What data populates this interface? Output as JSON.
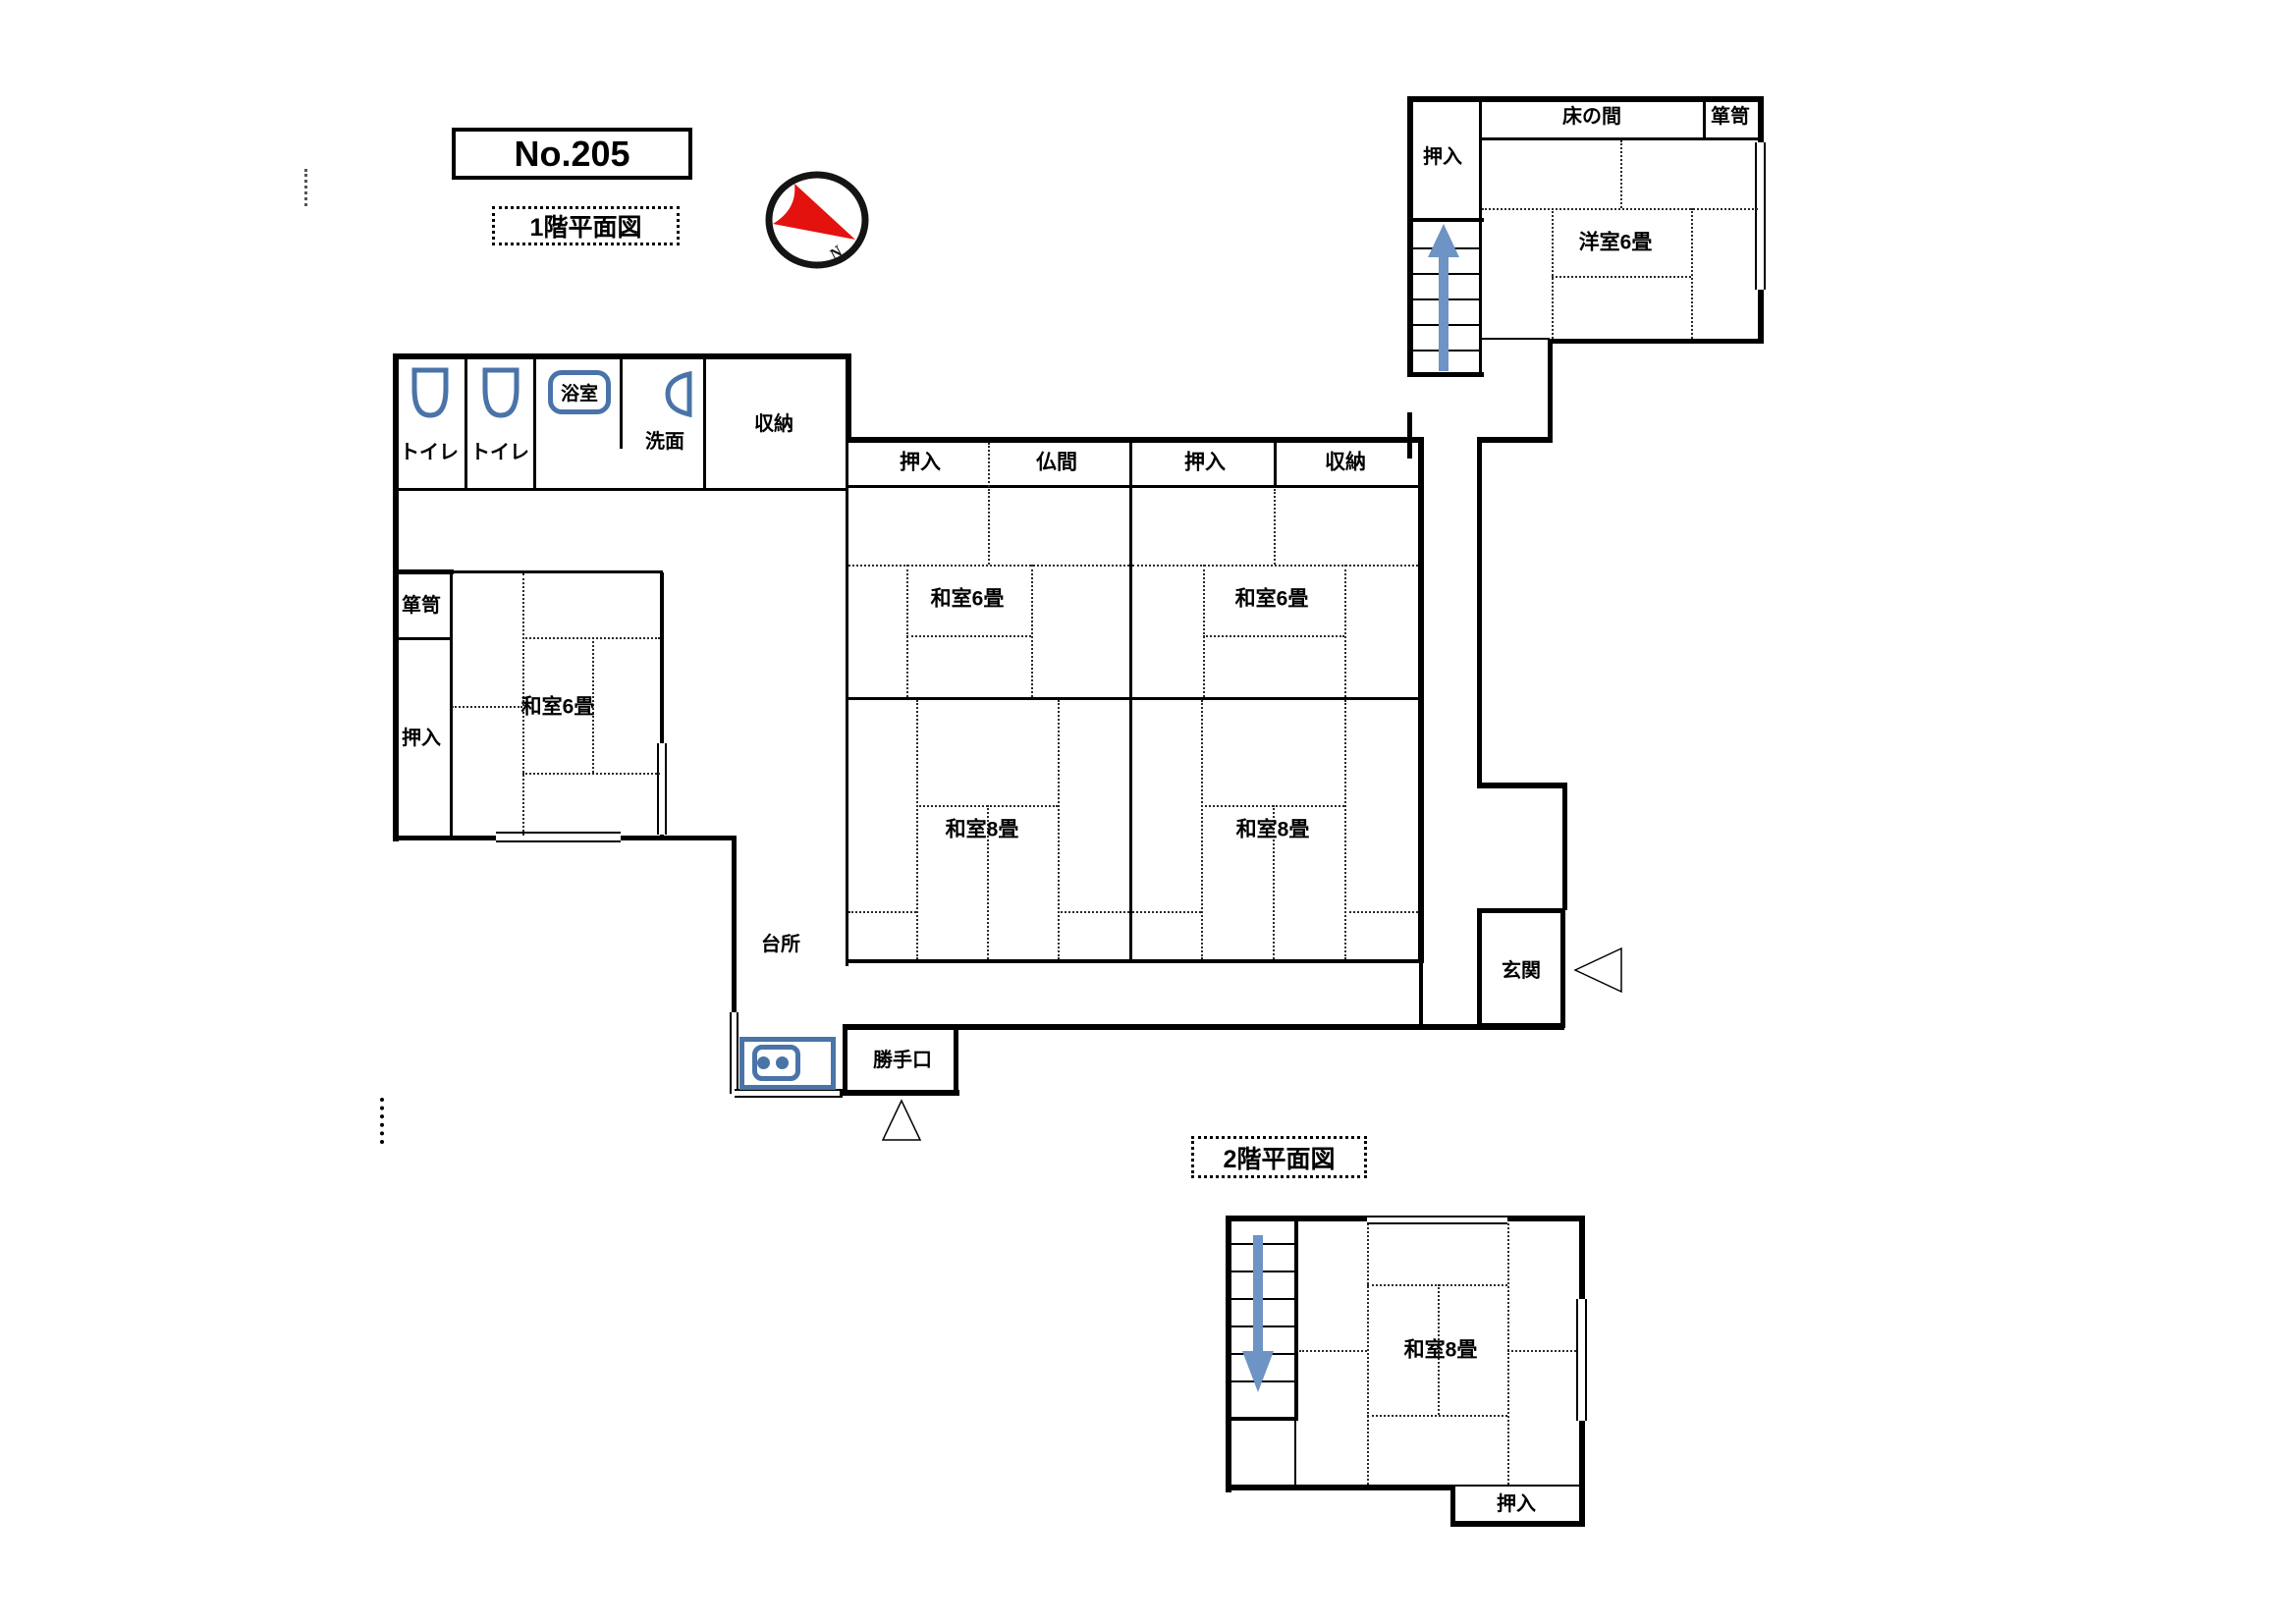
{
  "page": {
    "title": "No.205",
    "floor1_caption": "1階平面図",
    "floor2_caption": "2階平面図"
  },
  "compass": {
    "letter": "N"
  },
  "colors": {
    "line": "#000000",
    "fixture_blue": "#4a74a8",
    "arrow_blue": "#6e93c5",
    "compass_red": "#e3120e"
  },
  "floor1": {
    "utility": {
      "toilet1": "トイレ",
      "toilet2": "トイレ",
      "bath": "浴室",
      "washstand": "洗面",
      "storage": "収納"
    },
    "west": {
      "tansu": "箪笥",
      "closet": "押入",
      "room": "和室6畳"
    },
    "kitchen": {
      "name": "台所",
      "backdoor": "勝手口"
    },
    "center": {
      "closet_a": "押入",
      "altar": "仏間",
      "closet_b": "押入",
      "storage": "収納",
      "room6_a": "和室6畳",
      "room6_b": "和室6畳",
      "room8_a": "和室8畳",
      "room8_b": "和室8畳"
    },
    "northeast": {
      "closet": "押入",
      "alcove": "床の間",
      "tansu": "箪笥",
      "room": "洋室6畳"
    },
    "entrance": "玄関"
  },
  "floor2": {
    "room8": "和室8畳",
    "closet": "押入"
  }
}
